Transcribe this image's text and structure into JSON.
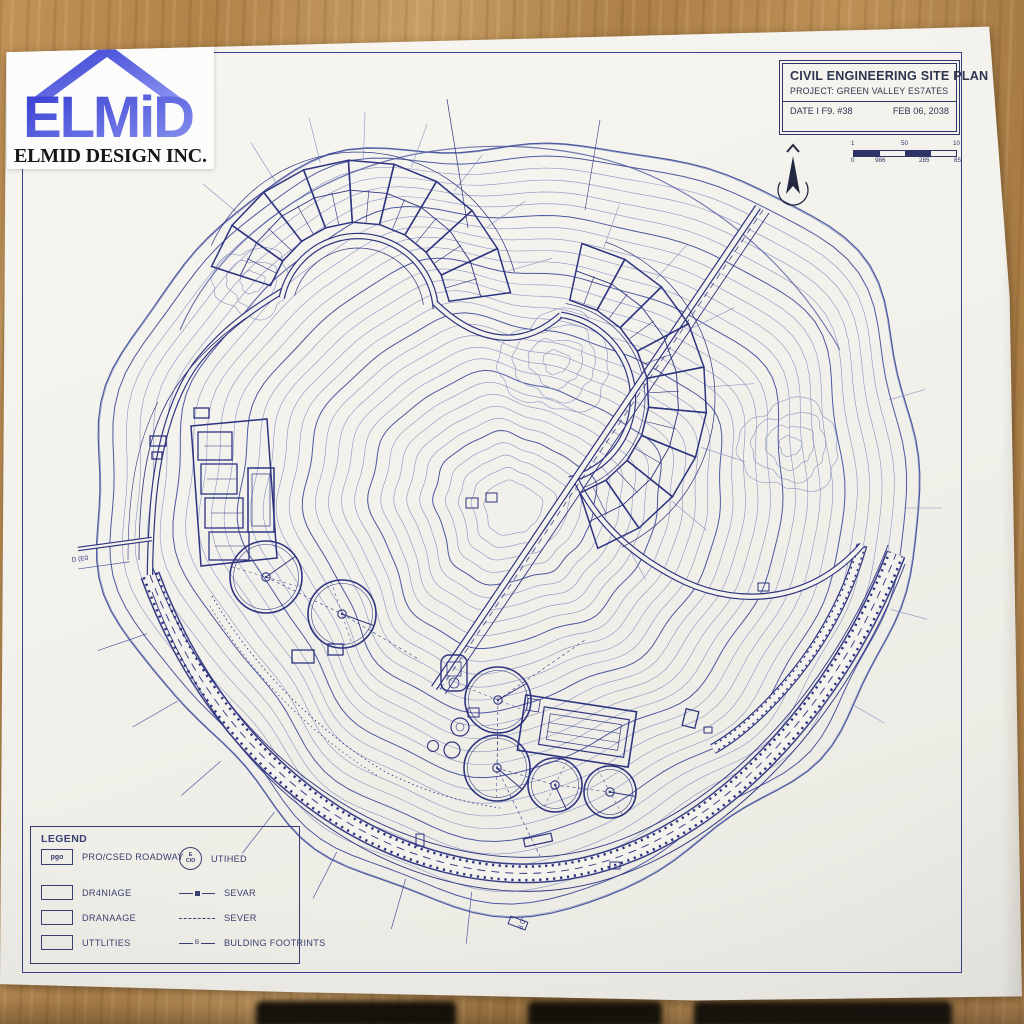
{
  "logo": {
    "brand": "ELMiD",
    "company": "ELMID DESIGN INC."
  },
  "title_block": {
    "title": "CIVIL ENGINEERING SITE PLAN",
    "project": "PROJECT: GREEN VALLEY ES7ATES",
    "date_label": "DATE I F9. #38",
    "date_value": "FEB 06, 2038"
  },
  "scale_bar": {
    "top_labels": [
      "1",
      "50",
      "10"
    ],
    "bottom_labels": [
      "0",
      "986",
      "285",
      "85"
    ]
  },
  "legend": {
    "title": "LEGEND",
    "roadway_symbol": "pgo",
    "roadway_label": "PRO/CSED ROADWAY",
    "utility_symbol_top": "E",
    "utility_symbol_bottom": "CIO",
    "utility_label": "UTIHED",
    "area_items": [
      {
        "label": "DR4NIAGE"
      },
      {
        "label": "DRANAAGE"
      },
      {
        "label": "UTTLITIES"
      }
    ],
    "line_items": [
      {
        "label": "SEVAR"
      },
      {
        "label": "SEVER"
      },
      {
        "label": "BULDING FOOTRINTS",
        "marker": "B"
      }
    ]
  },
  "plan_labels": {
    "stub": "D (E0",
    "bottom": "8 0°"
  },
  "colors": {
    "ink": "#2e3480",
    "contour": "#8a93c2",
    "contour_dark": "#4d58a0",
    "frame": "#39408a",
    "paper": "#f3f2ec",
    "wood": "#b5854f"
  }
}
